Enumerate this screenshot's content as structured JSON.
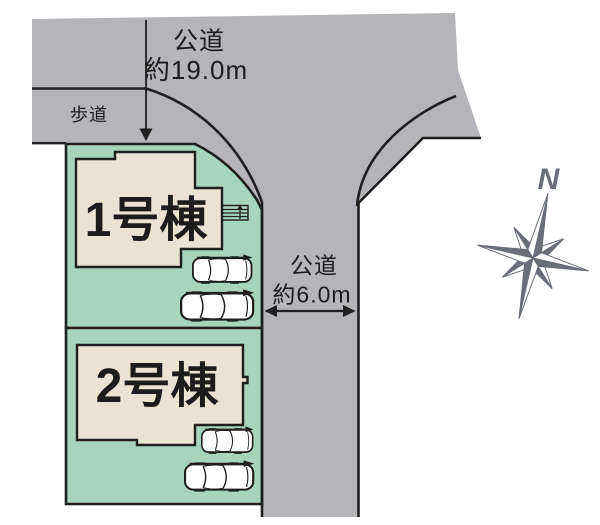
{
  "labels": {
    "road_top_name": "公道",
    "road_top_width": "約19.0m",
    "sidewalk": "歩道",
    "road_right_name": "公道",
    "road_right_width": "約6.0m",
    "building1": "1号棟",
    "building2": "2号棟",
    "compass_north": "N"
  },
  "colors": {
    "road_gray": "#b5b4b9",
    "plot_green": "#a7d4bd",
    "building_beige": "#eae2d3",
    "outline_black": "#1f1f1f",
    "compass_gray": "#6a6e78",
    "background": "#ffffff",
    "text": "#1c1c1c"
  }
}
